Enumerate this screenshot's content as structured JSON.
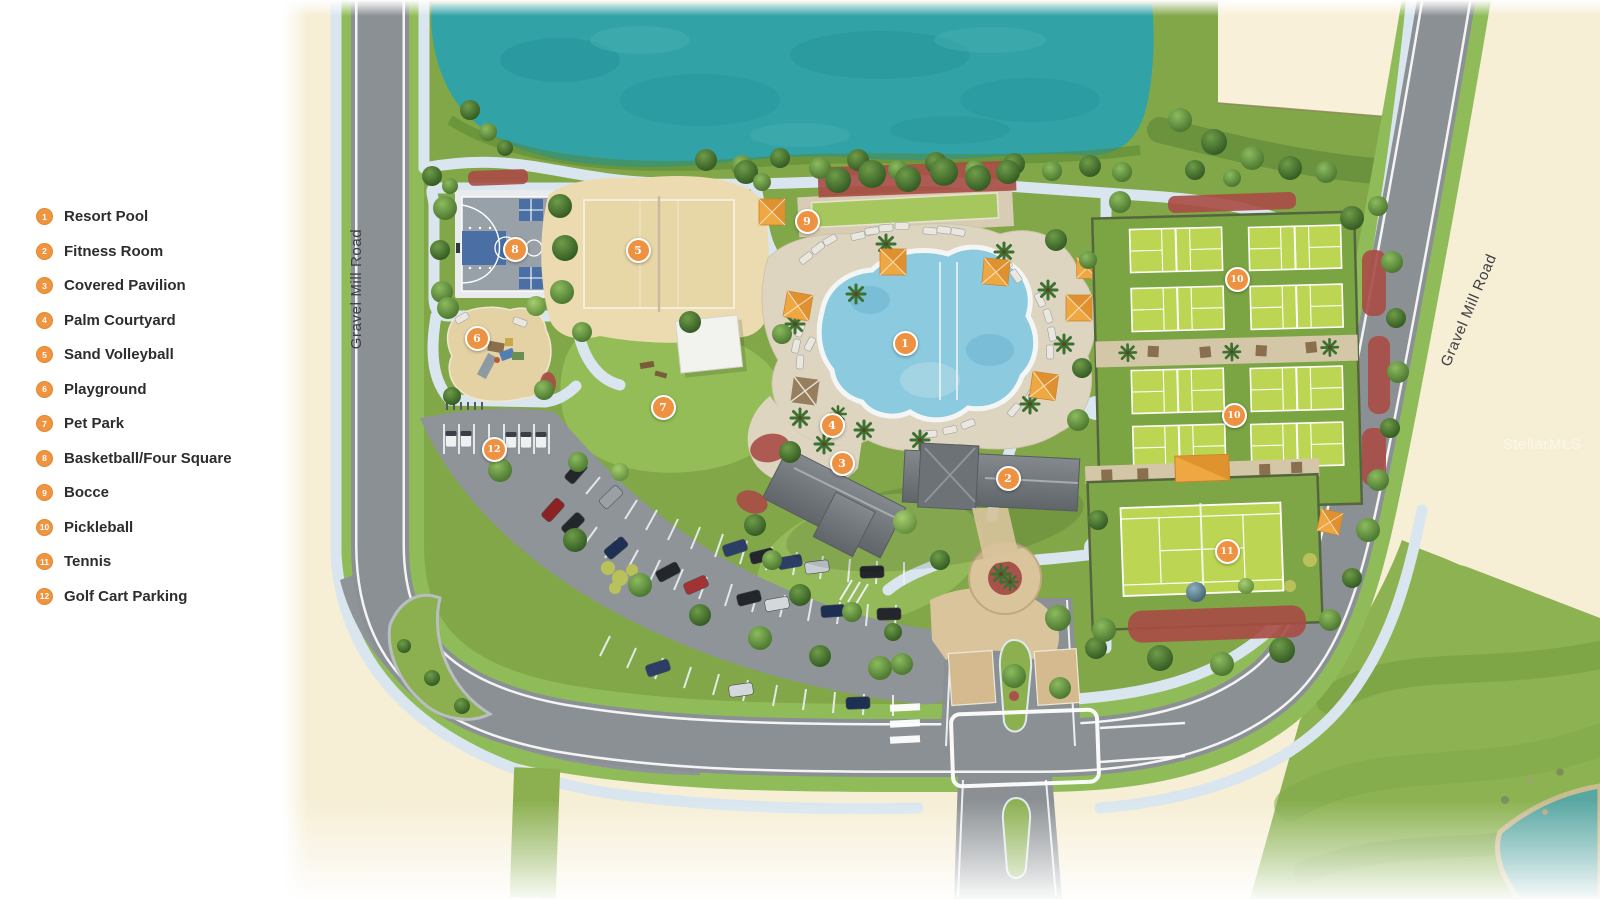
{
  "legend": {
    "items": [
      {
        "number": "1",
        "label": "Resort Pool"
      },
      {
        "number": "2",
        "label": "Fitness Room"
      },
      {
        "number": "3",
        "label": "Covered Pavilion"
      },
      {
        "number": "4",
        "label": "Palm Courtyard"
      },
      {
        "number": "5",
        "label": "Sand Volleyball"
      },
      {
        "number": "6",
        "label": "Playground"
      },
      {
        "number": "7",
        "label": "Pet Park"
      },
      {
        "number": "8",
        "label": "Basketball/Four Square"
      },
      {
        "number": "9",
        "label": "Bocce"
      },
      {
        "number": "10",
        "label": "Pickleball"
      },
      {
        "number": "11",
        "label": "Tennis"
      },
      {
        "number": "12",
        "label": "Golf Cart Parking"
      }
    ]
  },
  "map": {
    "road_labels": [
      {
        "text": "Gravel Mill Road"
      },
      {
        "text": "Gravel Mill Road"
      }
    ],
    "watermark": "StellarMLS",
    "markers": [
      {
        "number": "1",
        "label": "Resort Pool",
        "x": 905,
        "y": 343
      },
      {
        "number": "2",
        "label": "Fitness Room",
        "x": 1008,
        "y": 478
      },
      {
        "number": "3",
        "label": "Covered Pavilion",
        "x": 842,
        "y": 463
      },
      {
        "number": "4",
        "label": "Palm Courtyard",
        "x": 832,
        "y": 425
      },
      {
        "number": "5",
        "label": "Sand Volleyball",
        "x": 638,
        "y": 250
      },
      {
        "number": "6",
        "label": "Playground",
        "x": 477,
        "y": 338
      },
      {
        "number": "7",
        "label": "Pet Park",
        "x": 663,
        "y": 407
      },
      {
        "number": "8",
        "label": "Basketball/Four Square",
        "x": 515,
        "y": 249
      },
      {
        "number": "9",
        "label": "Bocce",
        "x": 807,
        "y": 221
      },
      {
        "number": "10",
        "label": "Pickleball",
        "x": 1237,
        "y": 279
      },
      {
        "number": "10",
        "label": "Pickleball",
        "x": 1234,
        "y": 415
      },
      {
        "number": "11",
        "label": "Tennis",
        "x": 1227,
        "y": 551
      },
      {
        "number": "12",
        "label": "Golf Cart Parking",
        "x": 494,
        "y": 449
      }
    ]
  },
  "colors": {
    "marker_orange": "#ee9140",
    "legend_orange": "#ef9440",
    "cream": "#f6eed5",
    "lake_teal": "#31a2a6",
    "grass_green": "#84aa4b",
    "road_gray": "#8b9094",
    "path_blue": "#d9e6ef",
    "pool_blue": "#8ccadf",
    "deck_tan": "#ded5c0",
    "sand": "#ecdbb0",
    "court_lime": "#bcd653",
    "court_blue": "#4a6fa5",
    "mulch_red": "#a84b45",
    "roof_gray": "#767b80",
    "umbrella_orange": "#efa742"
  }
}
